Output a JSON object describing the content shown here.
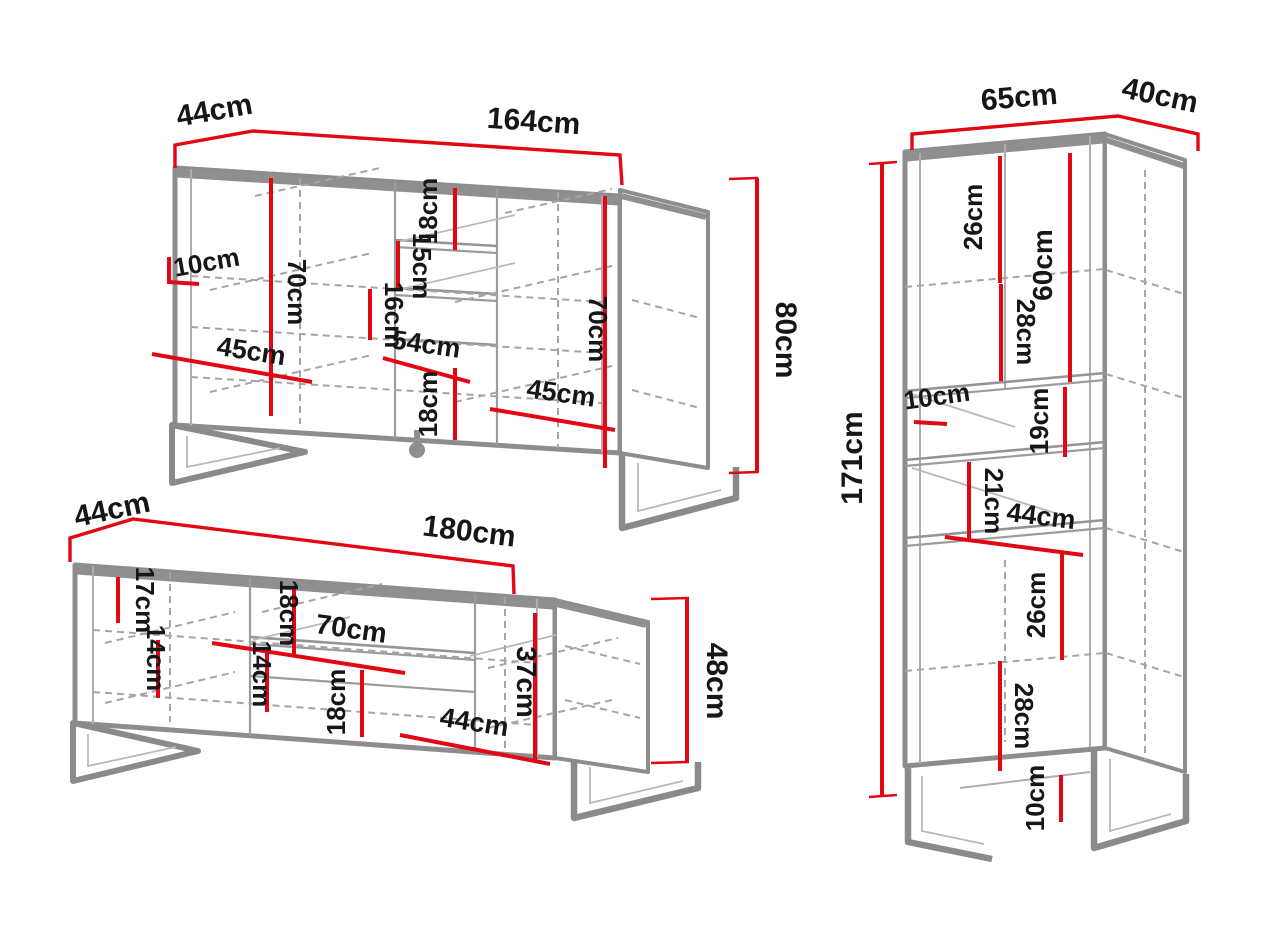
{
  "diagram": {
    "title": "Furniture set dimension drawing",
    "accent_color": "#e30613",
    "outline_color": "#8d8d8d",
    "sideboard": {
      "width": "164cm",
      "depth": "44cm",
      "height": "80cm",
      "top_inset": "18cm",
      "side_inset": "10cm",
      "left_door_height": "70cm",
      "upper_shelf_gap": "15cm",
      "lower_shelf_gap": "16cm",
      "left_door_width": "45cm",
      "center_section_width": "54cm",
      "bottom_inset": "18cm",
      "right_door_width": "45cm",
      "right_door_height": "70cm"
    },
    "tv_stand": {
      "width": "180cm",
      "depth": "44cm",
      "height": "48cm",
      "back_inset": "17cm",
      "left_shelf_gap": "14cm",
      "niche_height": "18cm",
      "center_shelf_gap": "14cm",
      "niche_width": "70cm",
      "drawer_height": "18cm",
      "right_door_width": "44cm",
      "door_height": "37cm"
    },
    "cabinet": {
      "width": "65cm",
      "depth": "40cm",
      "height": "171cm",
      "upper_shelf_gap": "26cm",
      "upper_section_height": "60cm",
      "upper_lower_gap": "28cm",
      "side_inset": "10cm",
      "niche_upper_height": "19cm",
      "niche_lower_height": "21cm",
      "niche_width": "44cm",
      "lower_shelf_gap": "26cm",
      "lower_section_height": "28cm",
      "leg_height": "10cm"
    }
  }
}
